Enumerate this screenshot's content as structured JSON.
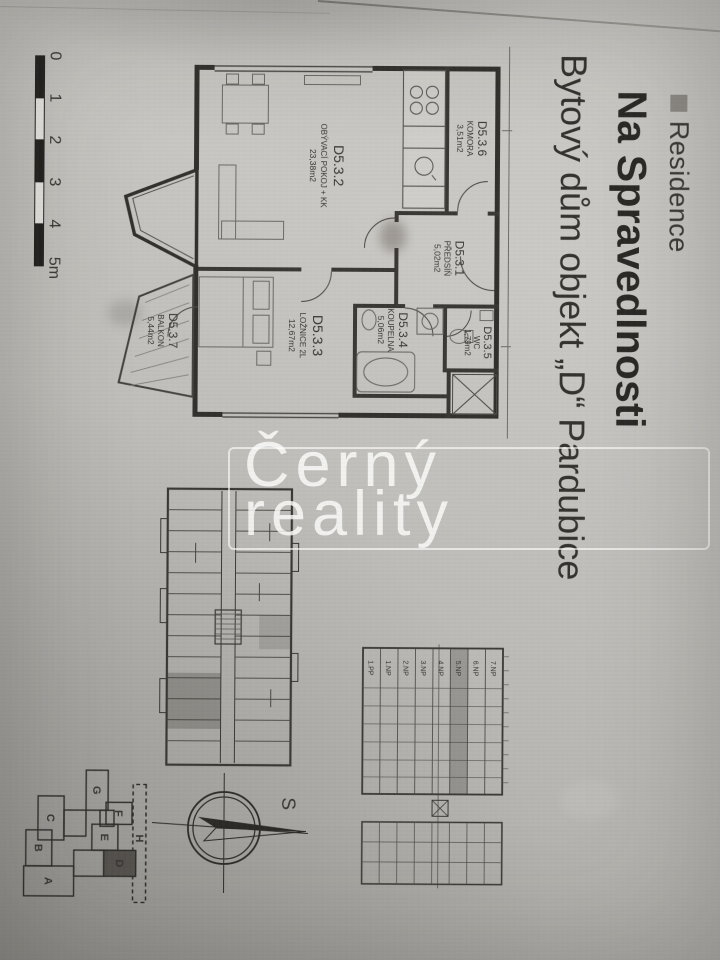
{
  "header": {
    "brand": "Residence",
    "project": "Na Spravedlnosti",
    "subtitle": "Bytový dům objekt „D“ Pardubice"
  },
  "watermark": {
    "word1": "Černý",
    "word2": "reality"
  },
  "floor_plan": {
    "unit": "D5.3",
    "rooms": {
      "predsin": {
        "id": "D5.3.1",
        "name": "PŘEDSÍŇ",
        "area": "5,02m2"
      },
      "obyvaci": {
        "id": "D5.3.2",
        "name": "OBÝVACÍ POKOJ + KK",
        "area": "23,38m2"
      },
      "loznice": {
        "id": "D5.3.3",
        "name": "LOŽNICE 2L",
        "area": "12,67m2"
      },
      "koupelna": {
        "id": "D5.3.4",
        "name": "KOUPELNA",
        "area": "5,06m2"
      },
      "wc": {
        "id": "D5.3.5",
        "name": "WC",
        "area": "1,79m2"
      },
      "komora": {
        "id": "D5.3.6",
        "name": "KOMORA",
        "area": "3,51m2"
      },
      "balkon": {
        "id": "D5.3.7",
        "name": "BALKON",
        "area": "5,44m2"
      }
    }
  },
  "scale_bar": {
    "labels": [
      "0",
      "1",
      "2",
      "3",
      "4",
      "5m"
    ]
  },
  "section": {
    "floors": [
      "7.NP",
      "6.NP",
      "5.NP",
      "4.NP",
      "3.NP",
      "2.NP",
      "1.NP",
      "1.PP"
    ],
    "highlighted_floor": "5.NP"
  },
  "site_plan": {
    "buildings": [
      "H",
      "G",
      "F",
      "E",
      "D",
      "C",
      "B",
      "A"
    ],
    "highlighted_building": "D"
  },
  "compass": {
    "north_label": "S"
  },
  "colors": {
    "ink": "#393733",
    "paper": "#c0beba",
    "highlight": "#55524e",
    "watermark": "#ffffff"
  }
}
